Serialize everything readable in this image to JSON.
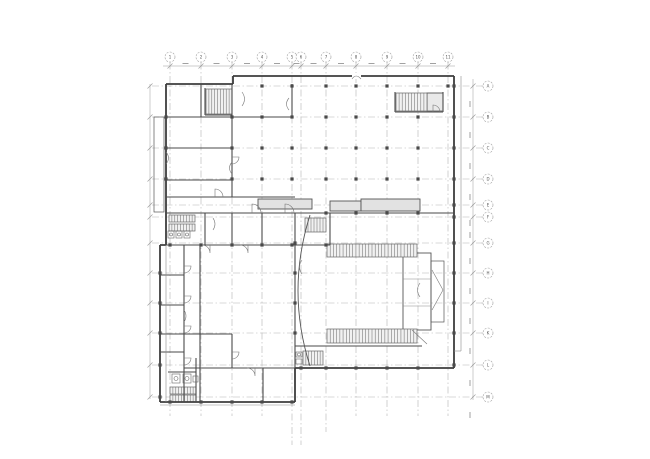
{
  "page": {
    "title": "architectural-floor-plan"
  },
  "canvas": {
    "w": 650,
    "h": 459,
    "bg": "#ffffff"
  },
  "palette": {
    "wall": "#3d3d3d",
    "inner": "#4a4a4a",
    "thin": "#8c8c8c",
    "grid": "#b4b4b4",
    "hatch": "#707070",
    "stair_fill": "#f1f1f1",
    "band_fill": "#e2e2e2",
    "landing_fill": "#e9e9e9",
    "bubble_stroke": "#9c9c9c",
    "label": "#555555",
    "dim": "#999999",
    "square": "#4a4a4a",
    "bg": "#ffffff"
  },
  "grid": {
    "cols": {
      "bubble_y": 57,
      "r": 5,
      "line_top": 62.5,
      "line_bottom": 416,
      "items": [
        {
          "x": 170,
          "label": "1"
        },
        {
          "x": 201,
          "label": "2"
        },
        {
          "x": 232,
          "label": "3"
        },
        {
          "x": 262,
          "label": "4"
        },
        {
          "x": 292,
          "label": "5",
          "ext": 445
        },
        {
          "x": 301,
          "label": "6",
          "ext": 445
        },
        {
          "x": 326,
          "label": "7",
          "ext": 432
        },
        {
          "x": 356,
          "label": "8"
        },
        {
          "x": 387,
          "label": "9"
        },
        {
          "x": 418,
          "label": "10"
        },
        {
          "x": 448,
          "label": "11"
        }
      ]
    },
    "rows": {
      "bubble_x": 488,
      "r": 5,
      "line_left": 152,
      "line_right": 481,
      "items": [
        {
          "y": 86,
          "label": "A"
        },
        {
          "y": 117,
          "label": "B"
        },
        {
          "y": 148,
          "label": "C"
        },
        {
          "y": 179,
          "label": "D"
        },
        {
          "y": 205,
          "label": "E"
        },
        {
          "y": 217,
          "label": "F"
        },
        {
          "y": 243,
          "label": "G"
        },
        {
          "y": 273,
          "label": "H"
        },
        {
          "y": 303,
          "label": "I"
        },
        {
          "y": 333,
          "label": "K"
        },
        {
          "y": 365,
          "label": "L"
        },
        {
          "y": 397,
          "label": "M"
        }
      ]
    }
  },
  "dims": {
    "top": {
      "y": 66,
      "x1": 163,
      "x2": 455
    },
    "right": {
      "x": 473,
      "y1": 79,
      "y2": 400
    },
    "left": {
      "x": 150,
      "y1": 84,
      "y2": 399
    }
  },
  "plan": {
    "outer": [
      [
        166,
        84,
        233,
        84
      ],
      [
        233,
        84,
        233,
        76
      ],
      [
        233,
        76,
        454,
        76
      ],
      [
        454,
        76,
        454,
        368
      ],
      [
        454,
        368,
        295,
        368
      ],
      [
        295,
        368,
        295,
        402
      ],
      [
        295,
        402,
        160,
        402
      ],
      [
        160,
        402,
        160,
        245
      ],
      [
        160,
        245,
        166,
        245
      ],
      [
        166,
        245,
        166,
        84
      ]
    ],
    "inner": [
      [
        232,
        84,
        232,
        197
      ],
      [
        201,
        84,
        201,
        117
      ],
      [
        292,
        84,
        292,
        117
      ],
      [
        166,
        117,
        292,
        117
      ],
      [
        166,
        148,
        232,
        148
      ],
      [
        166,
        180,
        232,
        180
      ],
      [
        166,
        197,
        295,
        197
      ],
      [
        166,
        213,
        454,
        213
      ],
      [
        160,
        245,
        330,
        245
      ],
      [
        330,
        213,
        330,
        245
      ],
      [
        205,
        213,
        205,
        245
      ],
      [
        232,
        213,
        232,
        245
      ],
      [
        262,
        213,
        262,
        245
      ],
      [
        184,
        245,
        184,
        402
      ],
      [
        200,
        245,
        200,
        402
      ],
      [
        160,
        275,
        184,
        275
      ],
      [
        160,
        305,
        184,
        305
      ],
      [
        160,
        334,
        232,
        334
      ],
      [
        160,
        352,
        184,
        352
      ],
      [
        232,
        334,
        232,
        368
      ],
      [
        184,
        368,
        295,
        368
      ],
      [
        263,
        368,
        263,
        402
      ],
      [
        295,
        213,
        295,
        368
      ],
      [
        295,
        346,
        422,
        346
      ],
      [
        168,
        372,
        196,
        372
      ],
      [
        196,
        358,
        196,
        402
      ],
      [
        205,
        88,
        205,
        115
      ],
      [
        205,
        115,
        232,
        115
      ],
      [
        395,
        92,
        395,
        112
      ],
      [
        395,
        112,
        443,
        112
      ],
      [
        443,
        92,
        443,
        112
      ]
    ],
    "thin": [
      [
        461,
        76,
        461,
        351
      ],
      [
        454,
        351,
        461,
        351
      ],
      [
        166,
        245,
        166,
        402
      ],
      [
        396,
        111,
        443,
        111
      ],
      [
        160,
        405,
        295,
        405
      ],
      [
        403,
        279,
        431,
        279
      ],
      [
        403,
        306,
        431,
        306
      ]
    ],
    "rects": [
      {
        "x": 258,
        "y": 199,
        "w": 54,
        "h": 10,
        "f": "band_fill"
      },
      {
        "x": 330,
        "y": 201,
        "w": 31,
        "h": 10,
        "f": "band_fill"
      },
      {
        "x": 361,
        "y": 199,
        "w": 59,
        "h": 12,
        "f": "band_fill"
      },
      {
        "x": 403,
        "y": 253,
        "w": 28,
        "h": 77
      },
      {
        "x": 431,
        "y": 261,
        "w": 13,
        "h": 61,
        "lw": 0.7
      },
      {
        "x": 427,
        "y": 93,
        "w": 16,
        "h": 18,
        "f": "landing_fill"
      },
      {
        "x": 154,
        "y": 117,
        "w": 10,
        "h": 95,
        "lw": 0.7
      }
    ],
    "wall_break": {
      "x": 352,
      "y": 73,
      "w": 9,
      "h": 6
    },
    "stairs": [
      [
        206,
        89,
        26,
        25,
        9
      ],
      [
        396,
        93,
        31,
        18,
        10
      ],
      [
        169,
        215,
        26,
        7,
        9
      ],
      [
        169,
        224,
        26,
        7,
        9
      ],
      [
        305,
        218,
        21,
        14,
        7
      ],
      [
        327,
        244,
        90,
        13,
        28
      ],
      [
        327,
        329,
        90,
        14,
        28
      ],
      [
        303,
        351,
        20,
        14,
        7
      ],
      [
        170,
        387,
        26,
        7,
        9
      ],
      [
        170,
        395,
        26,
        7,
        9
      ]
    ],
    "squares_h": [
      {
        "y": 86,
        "xs": [
          262,
          292,
          326,
          356,
          387,
          418,
          448
        ]
      },
      {
        "y": 117,
        "xs": [
          262,
          292,
          326,
          356,
          387,
          418
        ]
      },
      {
        "y": 148,
        "xs": [
          262,
          292,
          326,
          356,
          387,
          418
        ]
      },
      {
        "y": 179,
        "xs": [
          262,
          292,
          326,
          356,
          387,
          418
        ]
      },
      {
        "y": 213,
        "xs": [
          326,
          356,
          387,
          418
        ]
      },
      {
        "y": 245,
        "xs": [
          170,
          201,
          232,
          262,
          292,
          326
        ]
      },
      {
        "y": 368,
        "xs": [
          301,
          326,
          356,
          387,
          418
        ]
      },
      {
        "y": 402,
        "xs": [
          170,
          201,
          232,
          262,
          292
        ]
      }
    ],
    "squares_v": [
      {
        "x": 295,
        "ys": [
          243,
          273,
          303,
          333
        ]
      },
      {
        "x": 454,
        "ys": [
          86,
          117,
          148,
          179,
          205,
          217,
          243,
          273,
          303,
          333,
          365
        ]
      },
      {
        "x": 166,
        "ys": [
          117,
          148,
          179
        ]
      },
      {
        "x": 160,
        "ys": [
          273,
          303,
          333,
          365,
          397
        ]
      },
      {
        "x": 232,
        "ys": [
          117,
          148,
          179
        ]
      }
    ],
    "fixtures": {
      "rects": [
        [
          168,
          231,
          6,
          7
        ],
        [
          176,
          231,
          6,
          7
        ],
        [
          184,
          231,
          6,
          7
        ],
        [
          172,
          374,
          8,
          9
        ],
        [
          183,
          374,
          8,
          9
        ],
        [
          193,
          376,
          5,
          6
        ],
        [
          296,
          352,
          6,
          5
        ],
        [
          296,
          359,
          6,
          5
        ]
      ],
      "circles": [
        [
          171,
          234.5,
          1.5
        ],
        [
          179,
          234.5,
          1.5
        ],
        [
          187,
          234.5,
          1.5
        ],
        [
          176,
          378.5,
          2
        ],
        [
          187,
          378.5,
          2
        ],
        [
          299,
          354.5,
          1.5
        ]
      ]
    },
    "curve": "M310,215 Q286,291 310,366",
    "door_arcs": [
      "M252,213 L252,204 A9,9 0 0 1 261,213",
      "M285,213 L285,204 A9,9 0 0 1 294,213",
      "M215,197 L215,189 A8,8 0 0 1 223,197",
      "M248,245 L248,253 A8,8 0 0 0 240,245",
      "M210,245 L210,253 A8,8 0 0 0 202,245",
      "M184,266 L191,266 A7,7 0 0 1 184,273",
      "M184,296 L191,296 A7,7 0 0 1 184,303",
      "M184,326 L191,326 A7,7 0 0 1 184,333",
      "M184,358 L191,358 A7,7 0 0 1 184,365",
      "M255,368 L255,376 A8,8 0 0 0 247,368",
      "M232,352 L239,352 A7,7 0 0 1 232,359",
      "M433,112 L433,105 A7,7 0 0 1 440,112",
      "M232,157 L239,157 A7,7 0 0 1 232,164"
    ],
    "squiggles": [
      "M242,92 q5,7 0,14",
      "M166,152 q5,6 0,12",
      "M232,162 q-5,6 0,12",
      "M213,218 q4,6 0,12",
      "M289,98 q-5,6 0,12",
      "M420,283 q-5,7 0,14",
      "M184,310 q4,6 0,12",
      "M302,260 q-5,7 0,14",
      "M352,79 q4,-6 9,0",
      "M412,330 L427,344",
      "M432,270 L443,290",
      "M443,290 L432,310"
    ]
  }
}
